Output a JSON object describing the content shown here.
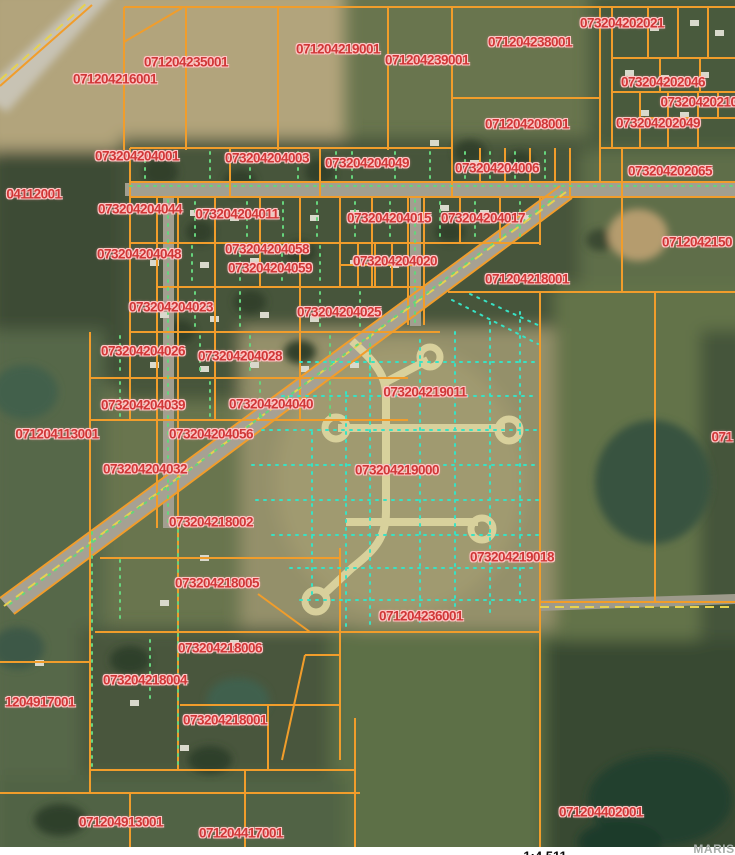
{
  "map": {
    "type": "gis-parcel-aerial-map",
    "scale_text": "1:4,511",
    "watermark": "MARIS",
    "colors": {
      "parcel_line": "#f19d2b",
      "label_fill": "#d03737",
      "label_halo": "#ffc6c6",
      "subdivision_lot_dots": "#38e2c4",
      "road_centerline_dash": "#e6d24f",
      "utility_dots": "#66d47c"
    },
    "parcel_labels": [
      {
        "id": "071204216001",
        "x": 115,
        "y": 79
      },
      {
        "id": "071204235001",
        "x": 186,
        "y": 62
      },
      {
        "id": "071204219001",
        "x": 338,
        "y": 49
      },
      {
        "id": "071204239001",
        "x": 427,
        "y": 60
      },
      {
        "id": "071204238001",
        "x": 530,
        "y": 42
      },
      {
        "id": "073204202021",
        "x": 622,
        "y": 23
      },
      {
        "id": "073204202046",
        "x": 663,
        "y": 82
      },
      {
        "id": "07320420210",
        "x": 699,
        "y": 102
      },
      {
        "id": "073204202049",
        "x": 658,
        "y": 123
      },
      {
        "id": "071204208001",
        "x": 527,
        "y": 124
      },
      {
        "id": "073204204006",
        "x": 497,
        "y": 168
      },
      {
        "id": "073204202065",
        "x": 670,
        "y": 171
      },
      {
        "id": "04112001",
        "x": 34,
        "y": 194
      },
      {
        "id": "073204204001",
        "x": 137,
        "y": 156
      },
      {
        "id": "073204204003",
        "x": 267,
        "y": 158
      },
      {
        "id": "073204204049",
        "x": 367,
        "y": 163
      },
      {
        "id": "073204204044",
        "x": 140,
        "y": 209
      },
      {
        "id": "073204204011",
        "x": 237,
        "y": 214
      },
      {
        "id": "073204204015",
        "x": 389,
        "y": 218
      },
      {
        "id": "073204204017",
        "x": 483,
        "y": 218
      },
      {
        "id": "0712042150",
        "x": 697,
        "y": 242
      },
      {
        "id": "073204204048",
        "x": 139,
        "y": 254
      },
      {
        "id": "073204204058",
        "x": 267,
        "y": 249
      },
      {
        "id": "073204204059",
        "x": 270,
        "y": 268
      },
      {
        "id": "073204204020",
        "x": 395,
        "y": 261
      },
      {
        "id": "071204218001",
        "x": 527,
        "y": 279
      },
      {
        "id": "073204204023",
        "x": 171,
        "y": 307
      },
      {
        "id": "073204204025",
        "x": 339,
        "y": 312
      },
      {
        "id": "073204204026",
        "x": 143,
        "y": 351
      },
      {
        "id": "073204204028",
        "x": 240,
        "y": 356
      },
      {
        "id": "073204204039",
        "x": 143,
        "y": 405
      },
      {
        "id": "073204204040",
        "x": 271,
        "y": 404
      },
      {
        "id": "073204219011",
        "x": 425,
        "y": 392
      },
      {
        "id": "071204113001",
        "x": 57,
        "y": 434
      },
      {
        "id": "073204204056",
        "x": 211,
        "y": 434
      },
      {
        "id": "071",
        "x": 722,
        "y": 437
      },
      {
        "id": "073204204032",
        "x": 145,
        "y": 469
      },
      {
        "id": "073204219000",
        "x": 397,
        "y": 470
      },
      {
        "id": "073204218002",
        "x": 211,
        "y": 522
      },
      {
        "id": "073204219018",
        "x": 512,
        "y": 557
      },
      {
        "id": "073204218005",
        "x": 217,
        "y": 583
      },
      {
        "id": "071204236001",
        "x": 421,
        "y": 616
      },
      {
        "id": "073204218006",
        "x": 220,
        "y": 648
      },
      {
        "id": "073204218004",
        "x": 145,
        "y": 680
      },
      {
        "id": "1204917001",
        "x": 40,
        "y": 702
      },
      {
        "id": "073204218001",
        "x": 225,
        "y": 720
      },
      {
        "id": "071204913001",
        "x": 121,
        "y": 822
      },
      {
        "id": "071204417001",
        "x": 241,
        "y": 833
      },
      {
        "id": "071204402001",
        "x": 601,
        "y": 812
      }
    ]
  }
}
